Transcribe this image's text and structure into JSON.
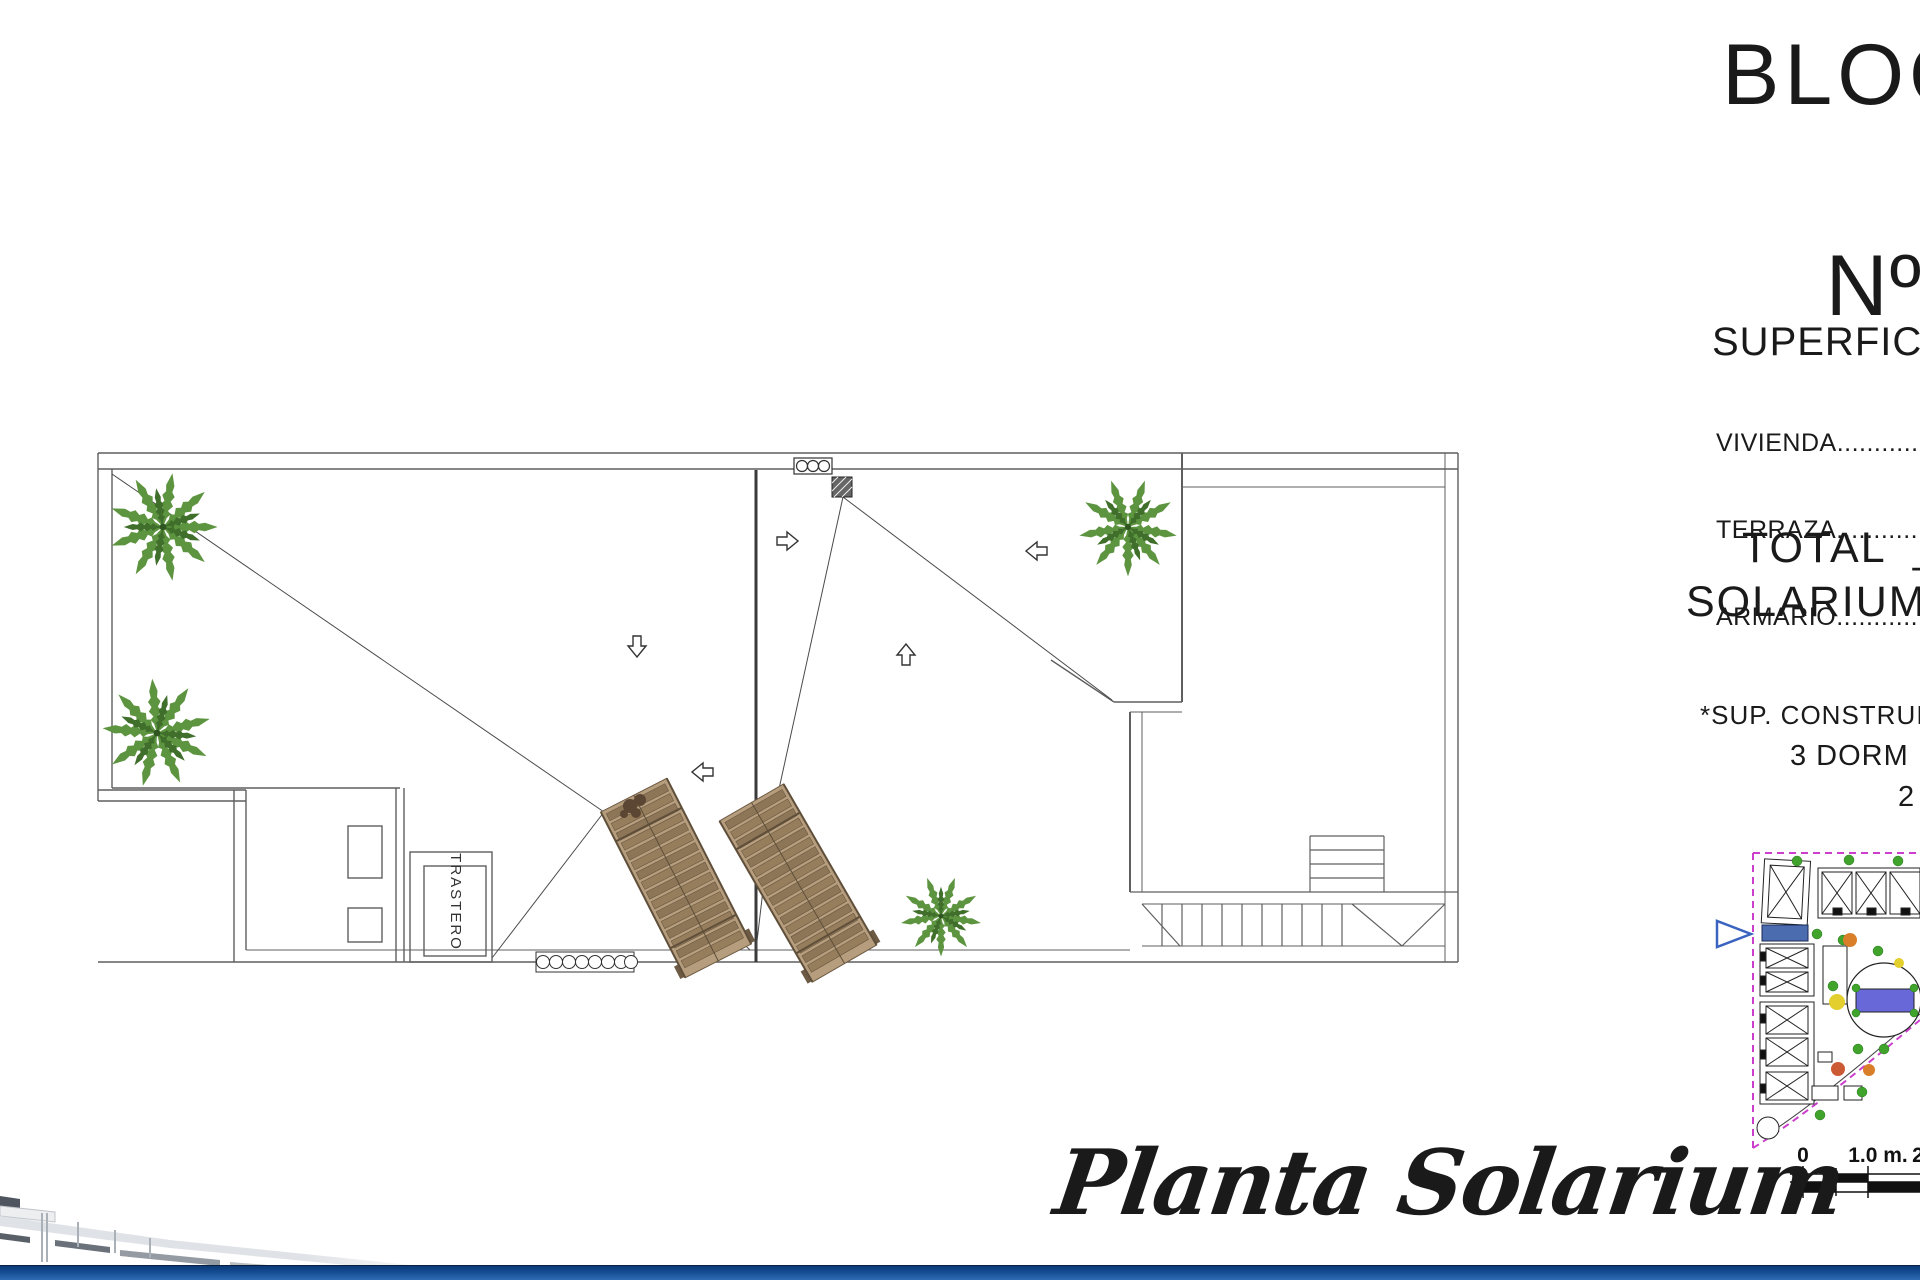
{
  "sheet": {
    "block_title": "BLOQ",
    "unit_label": "Nº:",
    "unit_value": "C",
    "caption": "Planta Solarium"
  },
  "surfaces": {
    "heading": "SUPERFICIE",
    "rows": [
      {
        "label": "VIVIENDA",
        "leader": "....................."
      },
      {
        "label": "TERRAZA",
        "leader": "....................."
      },
      {
        "label": "ARMARIO",
        "leader": "....................."
      }
    ],
    "total_line": "TOTAL  _  9",
    "solarium_line": "SOLARIUM_",
    "note_constructed": "*SUP. CONSTRUIDAS",
    "note_bedrooms": "3 DORM",
    "note_partial": "2"
  },
  "plan": {
    "storage_room_label": "TRASTERO"
  },
  "scale_bar": {
    "tick_zero": "0",
    "tick_one": "1.0 m.",
    "tick_two": "2"
  },
  "colors": {
    "palm_green": "#5d9440",
    "palm_green_dark": "#3f6f2a",
    "lounger_wood": "#8d7557",
    "lounger_frame": "#5f4f3a",
    "map_boundary_magenta": "#cc3fcc",
    "highlight_unit_blue": "#4c6cb0",
    "pool_blue": "#6868d8",
    "pointer_blue": "#3b63c0",
    "tree_green": "#3fa32c",
    "footer_blue_dark": "#0b3a77",
    "footer_blue": "#2f6cb3"
  }
}
